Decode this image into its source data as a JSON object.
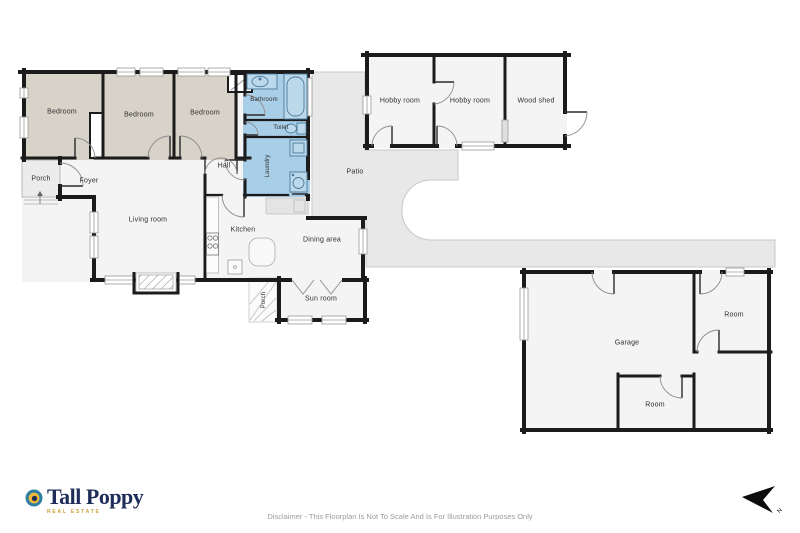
{
  "branding": {
    "name": "Tall Poppy",
    "tagline": "REAL ESTATE",
    "navy": "#1f2d5a",
    "gold": "#c9a23a"
  },
  "disclaimer": "Disclaimer - This Floorplan Is Not To Scale And Is For Illustration Purposes Only",
  "compass": {
    "label": "N"
  },
  "colors": {
    "wall": "#1b1b1b",
    "bedroom_fill": "#d8d3c9",
    "wet_room_fill": "#a9cee7",
    "interior_fill": "#f4f4f4",
    "patio_fill": "#e8e8e8"
  },
  "rooms": [
    {
      "label": "Porch"
    },
    {
      "label": "Foyer"
    },
    {
      "label": "Bedroom"
    },
    {
      "label": "Bedroom"
    },
    {
      "label": "Bedroom"
    },
    {
      "label": "Bathroom"
    },
    {
      "label": "Toilet"
    },
    {
      "label": "Laundry"
    },
    {
      "label": "Hall"
    },
    {
      "label": "Living room"
    },
    {
      "label": "Kitchen"
    },
    {
      "label": "Dining area"
    },
    {
      "label": "Sun room"
    },
    {
      "label": "Porch"
    },
    {
      "label": "Patio"
    },
    {
      "label": "Hobby room"
    },
    {
      "label": "Hobby room"
    },
    {
      "label": "Wood shed"
    },
    {
      "label": "Garage"
    },
    {
      "label": "Room"
    },
    {
      "label": "Room"
    }
  ]
}
